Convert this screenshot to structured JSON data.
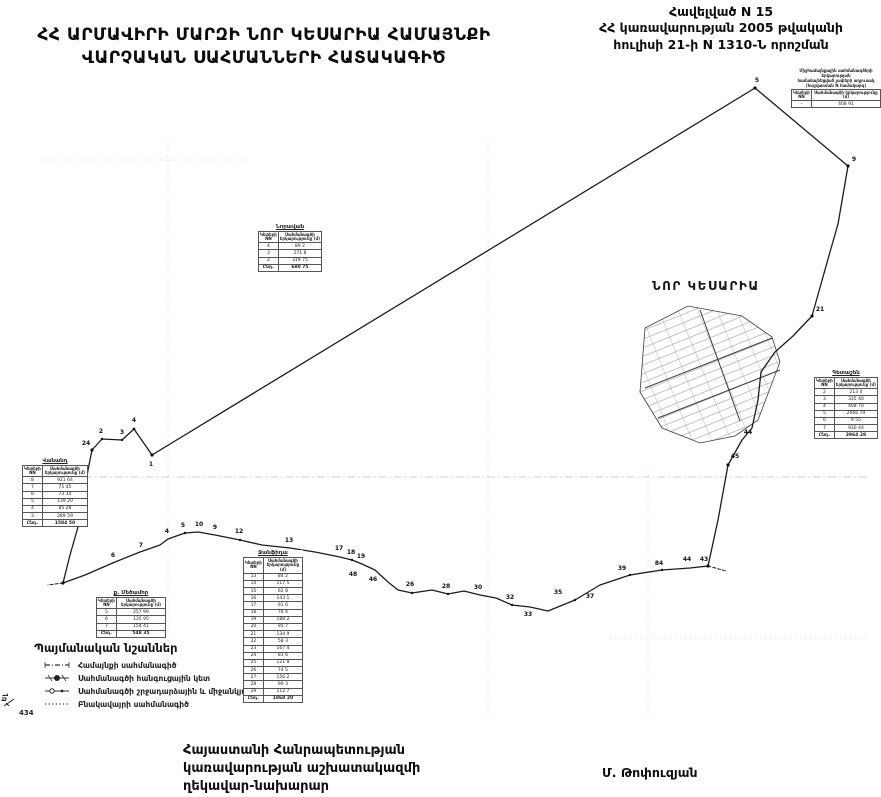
{
  "page": {
    "title_line1": "ՀՀ ԱՐՄԱՎԻՐԻ ՄԱՐԶԻ ՆՈՐ ԿԵՍԱՐԻԱ  ՀԱՄԱՅՆՔԻ",
    "title_line2": "ՎԱՐՉԱԿԱՆ ՍԱՀՄԱՆՆԵՐԻ ՀԱՏԱԿԱԳԻԾ"
  },
  "annotation": {
    "line1": "Հավելված N 15",
    "line2": "ՀՀ կառավարության 2005 թվականի",
    "line3": "հուլիսի 21-ի N 1310-Ն որոշման"
  },
  "map": {
    "settlement_label": "ՆՈՐ ԿԵՍԱՐԻԱ",
    "corner_label": "434",
    "corner_label2": "Ել",
    "point_labels": [
      {
        "t": "5",
        "x": 757,
        "y": 84
      },
      {
        "t": "9",
        "x": 854,
        "y": 163
      },
      {
        "t": "21",
        "x": 820,
        "y": 313
      },
      {
        "t": "45",
        "x": 735,
        "y": 460
      },
      {
        "t": "44",
        "x": 748,
        "y": 436
      },
      {
        "t": "24",
        "x": 86,
        "y": 447
      },
      {
        "t": "2",
        "x": 101,
        "y": 435
      },
      {
        "t": "3",
        "x": 122,
        "y": 436
      },
      {
        "t": "4",
        "x": 134,
        "y": 424
      },
      {
        "t": "1",
        "x": 151,
        "y": 468
      },
      {
        "t": "6",
        "x": 113,
        "y": 559
      },
      {
        "t": "7",
        "x": 141,
        "y": 549
      },
      {
        "t": "4",
        "x": 167,
        "y": 535
      },
      {
        "t": "5",
        "x": 183,
        "y": 529
      },
      {
        "t": "10",
        "x": 199,
        "y": 528
      },
      {
        "t": "9",
        "x": 215,
        "y": 531
      },
      {
        "t": "12",
        "x": 239,
        "y": 535
      },
      {
        "t": "13",
        "x": 289,
        "y": 544
      },
      {
        "t": "17",
        "x": 339,
        "y": 552
      },
      {
        "t": "18",
        "x": 351,
        "y": 556
      },
      {
        "t": "19",
        "x": 361,
        "y": 560
      },
      {
        "t": "48",
        "x": 353,
        "y": 578
      },
      {
        "t": "46",
        "x": 373,
        "y": 583
      },
      {
        "t": "26",
        "x": 410,
        "y": 588
      },
      {
        "t": "28",
        "x": 446,
        "y": 590
      },
      {
        "t": "30",
        "x": 478,
        "y": 591
      },
      {
        "t": "32",
        "x": 510,
        "y": 601
      },
      {
        "t": "33",
        "x": 528,
        "y": 618
      },
      {
        "t": "35",
        "x": 558,
        "y": 596
      },
      {
        "t": "37",
        "x": 590,
        "y": 600
      },
      {
        "t": "39",
        "x": 622,
        "y": 572
      },
      {
        "t": "84",
        "x": 659,
        "y": 567
      },
      {
        "t": "44",
        "x": 687,
        "y": 563
      },
      {
        "t": "43",
        "x": 704,
        "y": 563
      }
    ]
  },
  "tables": {
    "col_point": "Կետերի NN",
    "col_length": "Սահմանագծի երկարությունը (մ)",
    "total_label": "Ընդ.",
    "top_right": {
      "caption_line1": "Միջհամայնքային սահմանագծերի երկարության",
      "caption_line2": "համաձայնեցված չափերի աղյուսակ",
      "caption_line3": "(հաշվառման N համակարգ)",
      "rows": [
        [
          "–",
          "408 91"
        ]
      ]
    },
    "mid_upper": {
      "title": "Նորավան",
      "rows": [
        [
          "4",
          "89 2"
        ],
        [
          "3",
          "271 8"
        ],
        [
          "2",
          "319 75"
        ]
      ],
      "total": "680 75"
    },
    "left": {
      "title": "Վանանդ",
      "rows": [
        [
          "8",
          "921 64"
        ],
        [
          "7",
          "75 45"
        ],
        [
          "6",
          "73 34"
        ],
        [
          "5",
          "139 20"
        ],
        [
          "4",
          "85 28"
        ],
        [
          "3",
          "289 59"
        ]
      ],
      "total": "1584 50"
    },
    "long_south": {
      "title": "Ջանֆիդա",
      "rows": [
        [
          "13",
          "84 2"
        ],
        [
          "14",
          "117 5"
        ],
        [
          "15",
          "62 8"
        ],
        [
          "16",
          "143 1"
        ],
        [
          "17",
          "91 6"
        ],
        [
          "18",
          "76 4"
        ],
        [
          "19",
          "188 2"
        ],
        [
          "20",
          "95 7"
        ],
        [
          "21",
          "134 9"
        ],
        [
          "22",
          "58 3"
        ],
        [
          "23",
          "167 4"
        ],
        [
          "24",
          "83 6"
        ],
        [
          "25",
          "121 8"
        ],
        [
          "26",
          "74 5"
        ],
        [
          "27",
          "156 2"
        ],
        [
          "28",
          "99 3"
        ],
        [
          "29",
          "112 7"
        ]
      ],
      "total": "1868 20"
    },
    "small_south": {
      "title": "ք. Մեծամոր",
      "rows": [
        [
          "5",
          "257 99"
        ],
        [
          "6",
          "135 95"
        ],
        [
          "7",
          "154 41"
        ]
      ],
      "total": "548 35"
    },
    "right": {
      "title": "Գետաշեն",
      "rows": [
        [
          "2",
          "213 4"
        ],
        [
          "3",
          "335 40"
        ],
        [
          "4",
          "408 70"
        ],
        [
          "5",
          "2066 79"
        ],
        [
          "6",
          "9 55"
        ],
        [
          "7",
          "930 44"
        ]
      ],
      "total": "3964 28"
    }
  },
  "legend": {
    "title": "Պայմանական նշաններ",
    "items": [
      {
        "label": "Համայնքի սահմանագիծ"
      },
      {
        "label": "Սահմանագծի հանգուցային կետ"
      },
      {
        "label": "Սահմանագծի շրջադարձային և միջանկյալ կետեր"
      },
      {
        "label": "Բնակավայրի սահմանագիծ"
      }
    ]
  },
  "footer": {
    "line1": "Հայաստանի Հանրապետության",
    "line2": "կառավարության աշխատակազմի",
    "line3": "ղեկավար-նախարար",
    "signature": "Մ. Թոփուզյան"
  }
}
